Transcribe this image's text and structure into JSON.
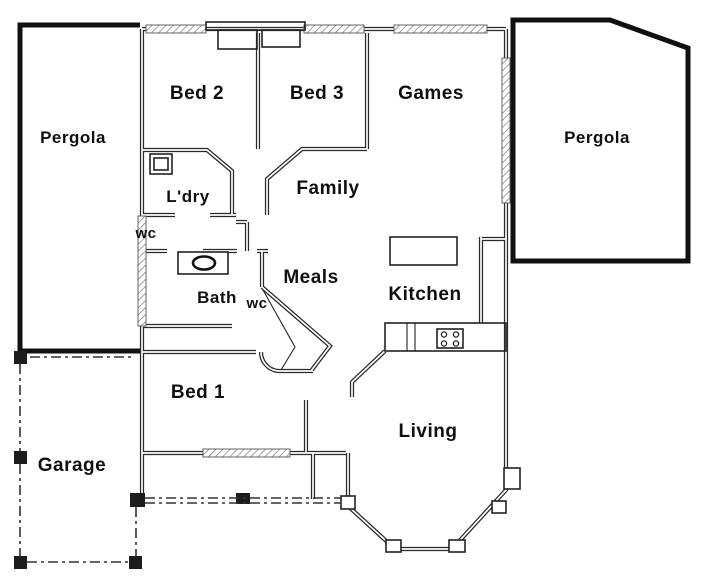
{
  "title": "House floor plan",
  "rooms": {
    "pergola_left": "Pergola",
    "bed2": "Bed 2",
    "bed3": "Bed 3",
    "games": "Games",
    "pergola_right": "Pergola",
    "laundry": "L'dry",
    "family": "Family",
    "wc_upper": "wc",
    "meals": "Meals",
    "bath": "Bath",
    "wc_lower": "wc",
    "kitchen": "Kitchen",
    "bed1": "Bed 1",
    "living": "Living",
    "garage": "Garage"
  },
  "fixtures": {
    "bathtub": "bathtub-icon",
    "laundry_trough": "laundry-trough-icon",
    "kitchen_island": "kitchen-island-bench",
    "cooktop": "cooktop-icon",
    "wardrobes": "built-in-robes"
  },
  "colors": {
    "background": "#ffffff",
    "wall": "#2a2a2a",
    "pergola_outline": "#111111",
    "hatch": "#7a7a7a",
    "text": "#101010"
  }
}
